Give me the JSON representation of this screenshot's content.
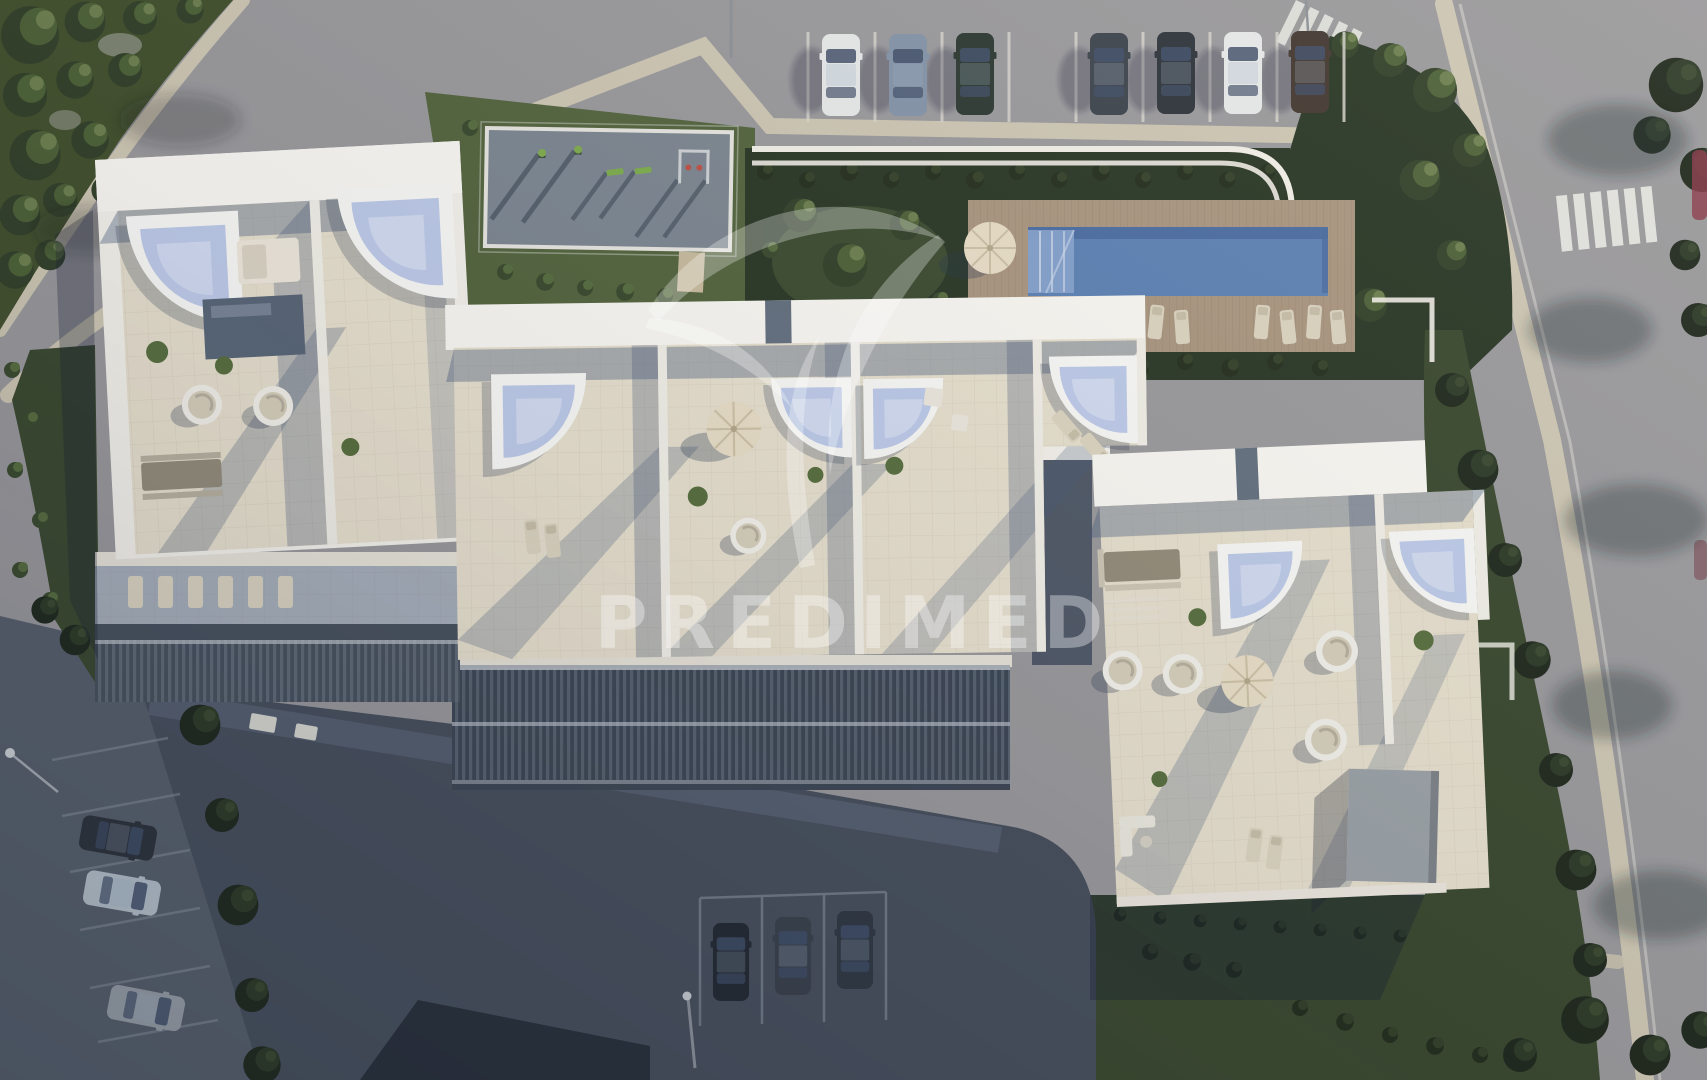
{
  "watermark": {
    "brand": "PREDIMED",
    "logo": "palm-leaves-icon"
  },
  "palette": {
    "road": "#9b9a9d",
    "road_shadow": "#59616d",
    "sidewalk": "#cfc7b4",
    "grass": "#55663f",
    "grass_dark": "#3c4a30",
    "hedge": "#2c3826",
    "roof_white": "#f6f3ec",
    "roof_bright": "#fbf9f4",
    "terrace": "#e9e1cf",
    "wall_white": "#f3f0e8",
    "shadow_blue": "rgba(58,76,110,0.42)",
    "terrace_shadow": "rgba(72,92,124,0.38)",
    "jacuzzi_rim": "#fafaf7",
    "jacuzzi_water": "#bfccea",
    "jacuzzi_hl": "#e3eaf8",
    "pool_water": "#5e83b5",
    "pool_deep": "#4a6ba0",
    "pool_steps": "#8aa5cf",
    "deck": "#ac9781",
    "deck_line": "#97826c",
    "asphalt_dark": "#49515e",
    "asphalt_mid": "#657082",
    "stall_line": "#d8d5cd",
    "pad_gray": "#7e8892",
    "equip_green": "#7fae4e",
    "equip_red": "#c05248",
    "umbrella": "#eadfc7",
    "lounger": "#ddd5c1",
    "furniture_brown": "#958d7b",
    "utility_gray": "#9da3a7",
    "car_white": "#e9eaea",
    "car_steel": "#8595a8",
    "car_green": "#2f3a33",
    "car_gray": "#3f454e",
    "car_graphite": "#30353d",
    "car_brown": "#443a32",
    "car_light_blue": "#b9c3cd",
    "car_silver": "#9aa1a9",
    "watermark_fill": "rgba(255,255,255,0.36)"
  },
  "scene": {
    "setting": "aerial top-down 3D render of a white residential apartment complex",
    "features": [
      "curved access road with sidewalks",
      "row parking with cars",
      "rooftop terraces with corner jacuzzis",
      "communal pool on timber deck with loungers and parasol",
      "children playground pad",
      "landscaped gardens with trees and hedges",
      "zebra crosswalks",
      "shaded courtyard parking"
    ],
    "top_parking_car_colors": [
      "white",
      "steel-blue",
      "dark-green",
      "dark-gray",
      "graphite",
      "white",
      "dark-brown"
    ],
    "street_parking_car_colors": [
      "graphite",
      "light-blue",
      "silver-gray"
    ],
    "courtyard_car_colors": [
      "graphite",
      "dark-gray",
      "gunmetal"
    ],
    "counts": {
      "rooftop_jacuzzis": 8,
      "pool_loungers": 8,
      "parasols": 4,
      "playground_items": 5,
      "egg_chairs": 7
    }
  }
}
